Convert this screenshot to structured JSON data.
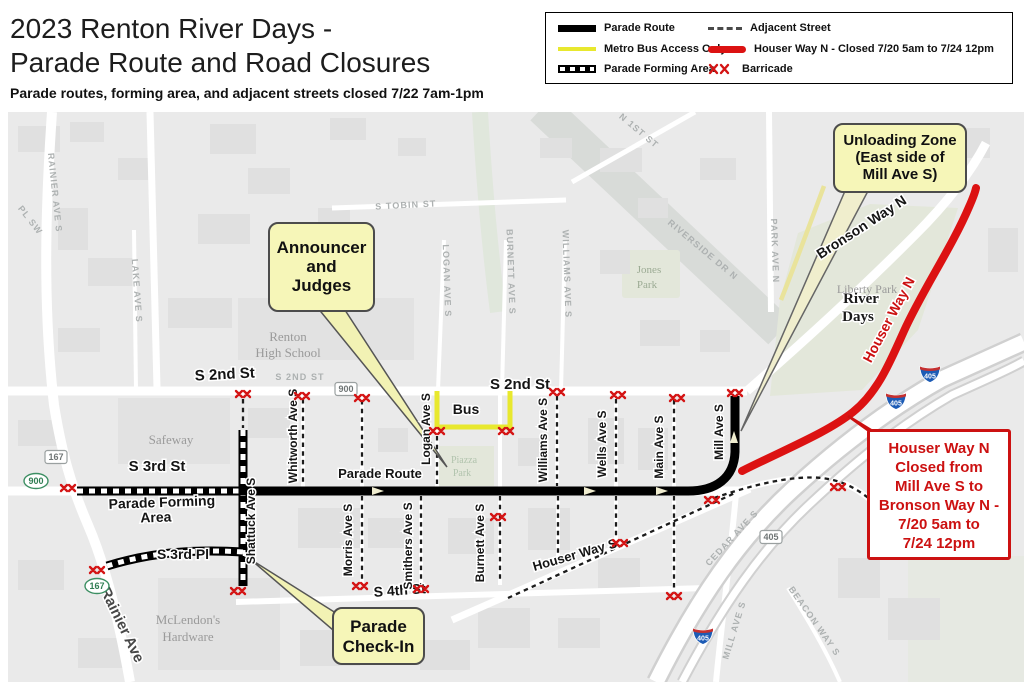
{
  "header": {
    "title_line1": "2023 Renton River Days -",
    "title_line2": "Parade Route and Road Closures",
    "subtitle": "Parade routes, forming area, and adjacent streets closed 7/22 7am-1pm"
  },
  "legend": {
    "items": [
      {
        "label": "Parade Route"
      },
      {
        "label": "Metro Bus Access Only"
      },
      {
        "label": "Parade Forming Area"
      },
      {
        "label": "Adjacent Street"
      },
      {
        "label": "Houser Way N - Closed 7/20 5am to 7/24 12pm"
      },
      {
        "label": "Barricade"
      }
    ]
  },
  "callouts": {
    "announcer": {
      "lines": [
        "Announcer",
        "and",
        "Judges"
      ]
    },
    "unloading": {
      "lines": [
        "Unloading Zone",
        "(East side of",
        "Mill Ave S)"
      ]
    },
    "checkin": {
      "lines": [
        "Parade",
        "Check-In"
      ]
    },
    "houser_closure": {
      "lines": [
        "Houser Way N",
        "Closed from",
        "Mill Ave S to",
        "Bronson Way N -",
        "7/20 5am to",
        "7/24 12pm"
      ]
    }
  },
  "map": {
    "colors": {
      "parade_route": "#000000",
      "metro_bus": "#e8e82e",
      "closure_red": "#dc1212",
      "barricade_red": "#d41414",
      "callout_bg": "#f6f6b8",
      "map_bg": "#eaeaea",
      "park_green": "#e3e7da"
    },
    "labels": [
      {
        "t": "S 2nd St",
        "x": 225,
        "y": 379,
        "r": -3,
        "s": 15
      },
      {
        "t": "S 2nd St",
        "x": 520,
        "y": 389,
        "s": 15
      },
      {
        "t": "S 3rd St",
        "x": 157,
        "y": 471,
        "s": 15
      },
      {
        "t": "S 3rd Pl",
        "x": 183,
        "y": 559,
        "s": 14
      },
      {
        "t": "S 4th St",
        "x": 400,
        "y": 595,
        "r": -4,
        "s": 14
      },
      {
        "t": "Houser Way S",
        "x": 576,
        "y": 559,
        "r": -16,
        "s": 13
      },
      {
        "t": "Bronson Way N",
        "x": 864,
        "y": 231,
        "r": -33,
        "s": 14
      },
      {
        "t": "Whitworth Ave S",
        "x": 297,
        "y": 436,
        "r": -90,
        "s": 12
      },
      {
        "t": "Shattuck Ave S",
        "x": 255,
        "y": 521,
        "r": -90,
        "s": 12
      },
      {
        "t": "Morris Ave S",
        "x": 352,
        "y": 540,
        "r": -90,
        "s": 12
      },
      {
        "t": "Smithers Ave S",
        "x": 412,
        "y": 546,
        "r": -90,
        "s": 12
      },
      {
        "t": "Burnett Ave S",
        "x": 484,
        "y": 543,
        "r": -90,
        "s": 12
      },
      {
        "t": "Logan Ave S",
        "x": 430,
        "y": 429,
        "r": -90,
        "s": 12
      },
      {
        "t": "Williams Ave S",
        "x": 547,
        "y": 440,
        "r": -90,
        "s": 12
      },
      {
        "t": "Wells Ave S",
        "x": 606,
        "y": 444,
        "r": -90,
        "s": 12
      },
      {
        "t": "Main Ave S",
        "x": 663,
        "y": 447,
        "r": -90,
        "s": 12
      },
      {
        "t": "Mill Ave S",
        "x": 723,
        "y": 432,
        "r": -90,
        "s": 12
      },
      {
        "t": "Bus",
        "x": 466,
        "y": 414,
        "s": 14
      },
      {
        "t": "Parade Route",
        "x": 380,
        "y": 478,
        "s": 13
      },
      {
        "t": "Parade Forming",
        "x": 162,
        "y": 507,
        "r": -2,
        "s": 14
      },
      {
        "t": "Area",
        "x": 156,
        "y": 522,
        "r": -2,
        "s": 14
      },
      {
        "t": "Rainier Ave",
        "x": 118,
        "y": 627,
        "r": 64,
        "s": 15,
        "c": "d"
      },
      {
        "t": "Houser Way N",
        "x": 893,
        "y": 322,
        "r": -62,
        "s": 14,
        "c": "r"
      },
      {
        "t": "River",
        "x": 861,
        "y": 303,
        "s": 15,
        "c": "sb"
      },
      {
        "t": "Days",
        "x": 858,
        "y": 321,
        "s": 15,
        "c": "sb"
      },
      {
        "t": "Safeway",
        "x": 171,
        "y": 444,
        "s": 13,
        "c": "p"
      },
      {
        "t": "Renton",
        "x": 288,
        "y": 341,
        "s": 13,
        "c": "p"
      },
      {
        "t": "High School",
        "x": 288,
        "y": 357,
        "s": 13,
        "c": "p"
      },
      {
        "t": "McLendon's",
        "x": 188,
        "y": 624,
        "s": 13,
        "c": "p"
      },
      {
        "t": "Hardware",
        "x": 188,
        "y": 641,
        "s": 13,
        "c": "p"
      },
      {
        "t": "Liberty Park",
        "x": 867,
        "y": 293,
        "s": 12,
        "c": "p"
      },
      {
        "t": "Jones",
        "x": 649,
        "y": 273,
        "s": 11,
        "c": "g"
      },
      {
        "t": "Park",
        "x": 647,
        "y": 288,
        "s": 11,
        "c": "g"
      },
      {
        "t": "Piazza",
        "x": 464,
        "y": 463,
        "s": 10,
        "c": "z"
      },
      {
        "t": "Park",
        "x": 462,
        "y": 476,
        "s": 10,
        "c": "z"
      },
      {
        "t": "RAINIER AVE S",
        "x": 52,
        "y": 193,
        "r": 84,
        "s": 9,
        "c": "f"
      },
      {
        "t": "PL SW",
        "x": 28,
        "y": 222,
        "r": 52,
        "s": 9,
        "c": "f"
      },
      {
        "t": "LAKE AVE S",
        "x": 134,
        "y": 291,
        "r": 86,
        "s": 9,
        "c": "f"
      },
      {
        "t": "S 2ND ST",
        "x": 300,
        "y": 380,
        "s": 9,
        "c": "f"
      },
      {
        "t": "S TOBIN ST",
        "x": 406,
        "y": 208,
        "r": -3,
        "s": 9,
        "c": "f"
      },
      {
        "t": "N 1ST ST",
        "x": 637,
        "y": 133,
        "r": 40,
        "s": 9,
        "c": "f"
      },
      {
        "t": "RIVERSIDE DR N",
        "x": 701,
        "y": 252,
        "r": 40,
        "s": 9,
        "c": "f"
      },
      {
        "t": "PARK AVE N",
        "x": 772,
        "y": 251,
        "r": 88,
        "s": 9,
        "c": "f"
      },
      {
        "t": "LOGAN AVE S",
        "x": 444,
        "y": 281,
        "r": 88,
        "s": 9,
        "c": "f"
      },
      {
        "t": "BURNETT AVE S",
        "x": 508,
        "y": 272,
        "r": 88,
        "s": 9,
        "c": "f"
      },
      {
        "t": "WILLIAMS AVE S",
        "x": 564,
        "y": 274,
        "r": 88,
        "s": 9,
        "c": "f"
      },
      {
        "t": "CEDAR AVE S",
        "x": 734,
        "y": 540,
        "r": -47,
        "s": 9,
        "c": "f"
      },
      {
        "t": "MILL AVE S",
        "x": 737,
        "y": 631,
        "r": -73,
        "s": 9,
        "c": "f"
      },
      {
        "t": "BEACON WAY S",
        "x": 812,
        "y": 623,
        "r": 55,
        "s": 9,
        "c": "f"
      }
    ],
    "shields": {
      "oval": [
        {
          "t": "900",
          "x": 36,
          "y": 481
        },
        {
          "t": "167",
          "x": 97,
          "y": 586
        }
      ],
      "rect": [
        {
          "t": "900",
          "x": 346,
          "y": 389
        },
        {
          "t": "167",
          "x": 56,
          "y": 457
        },
        {
          "t": "405",
          "x": 771,
          "y": 537
        }
      ],
      "interstate": [
        {
          "t": "405",
          "x": 930,
          "y": 374
        },
        {
          "t": "405",
          "x": 896,
          "y": 401
        },
        {
          "t": "405",
          "x": 703,
          "y": 636
        }
      ]
    },
    "barricades": [
      [
        68,
        488
      ],
      [
        97,
        570
      ],
      [
        238,
        591
      ],
      [
        243,
        394
      ],
      [
        302,
        396
      ],
      [
        362,
        398
      ],
      [
        437,
        431
      ],
      [
        506,
        431
      ],
      [
        557,
        392
      ],
      [
        618,
        395
      ],
      [
        677,
        398
      ],
      [
        735,
        393
      ],
      [
        360,
        586
      ],
      [
        421,
        589
      ],
      [
        498,
        517
      ],
      [
        620,
        543
      ],
      [
        674,
        596
      ],
      [
        712,
        500
      ],
      [
        838,
        487
      ]
    ]
  }
}
